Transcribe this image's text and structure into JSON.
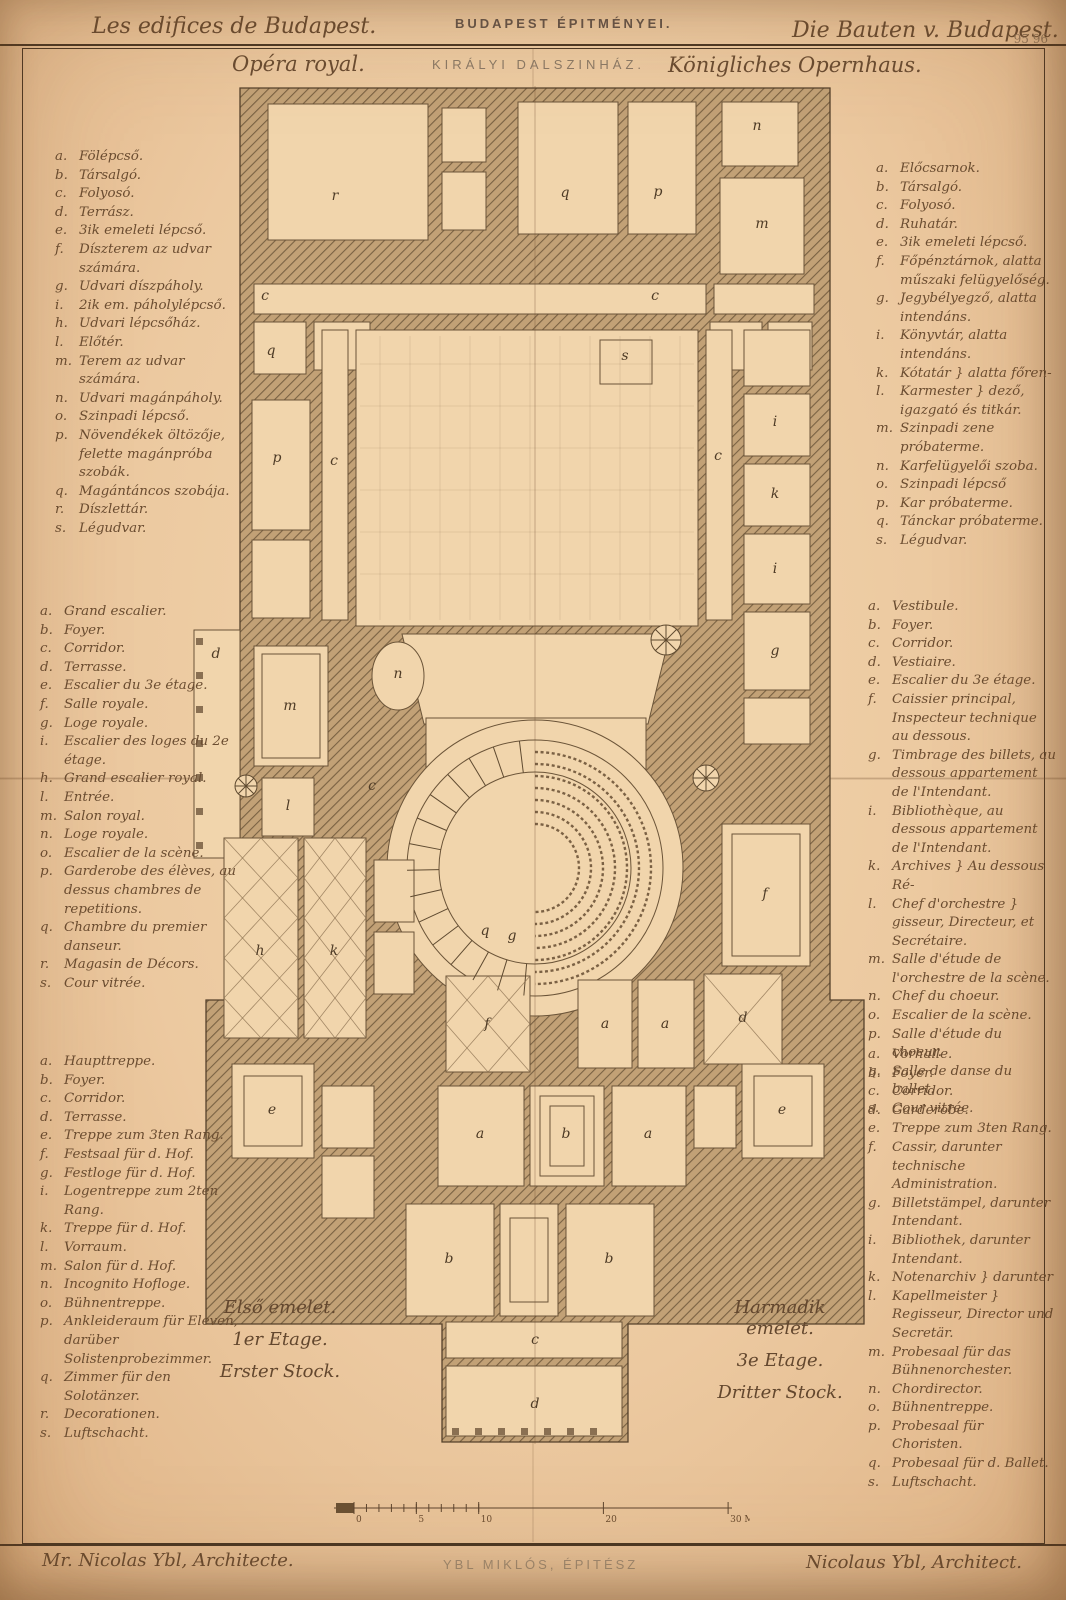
{
  "page": {
    "paper_color": "#ecc9a0",
    "ink_color": "#5d452e"
  },
  "header": {
    "left": "Les edifices de Budapest.",
    "center": "BUDAPEST ÉPITMÉNYEI.",
    "right": "Die Bauten v. Budapest.",
    "plate_number": "95 96"
  },
  "subtitles": {
    "french": "Opéra royal.",
    "hungarian": "KIRÁLYI DALSZINHÁZ.",
    "german": "Königliches Opernhaus."
  },
  "legends": {
    "left_hungarian": {
      "items": [
        {
          "key": "a.",
          "text": "Fölépcső."
        },
        {
          "key": "b.",
          "text": "Társalgó."
        },
        {
          "key": "c.",
          "text": "Folyosó."
        },
        {
          "key": "d.",
          "text": "Terrász."
        },
        {
          "key": "e.",
          "text": "3ik emeleti lépcső."
        },
        {
          "key": "f.",
          "text": "Díszterem az udvar számára."
        },
        {
          "key": "g.",
          "text": "Udvari díszpáholy."
        },
        {
          "key": "i.",
          "text": "2ik em. páholylépcső."
        },
        {
          "key": "h.",
          "text": "Udvari lépcsőház."
        },
        {
          "key": "l.",
          "text": "Előtér."
        },
        {
          "key": "m.",
          "text": "Terem az udvar számára."
        },
        {
          "key": "n.",
          "text": "Udvari magánpáholy."
        },
        {
          "key": "o.",
          "text": "Szinpadi lépcső."
        },
        {
          "key": "p.",
          "text": "Növendékek öltözője, felette magánpróba szobák."
        },
        {
          "key": "q.",
          "text": "Magántáncos szobája."
        },
        {
          "key": "r.",
          "text": "Díszlettár."
        },
        {
          "key": "s.",
          "text": "Légudvar."
        }
      ]
    },
    "left_french": {
      "items": [
        {
          "key": "a.",
          "text": "Grand escalier."
        },
        {
          "key": "b.",
          "text": "Foyer."
        },
        {
          "key": "c.",
          "text": "Corridor."
        },
        {
          "key": "d.",
          "text": "Terrasse."
        },
        {
          "key": "e.",
          "text": "Escalier du 3e étage."
        },
        {
          "key": "f.",
          "text": "Salle royale."
        },
        {
          "key": "g.",
          "text": "Loge royale."
        },
        {
          "key": "i.",
          "text": "Escalier des loges du 2e étage."
        },
        {
          "key": "h.",
          "text": "Grand escalier royal."
        },
        {
          "key": "l.",
          "text": "Entrée."
        },
        {
          "key": "m.",
          "text": "Salon royal."
        },
        {
          "key": "n.",
          "text": "Loge royale."
        },
        {
          "key": "o.",
          "text": "Escalier de la scène."
        },
        {
          "key": "p.",
          "text": "Garderobe des élèves, au dessus chambres de repetitions."
        },
        {
          "key": "q.",
          "text": "Chambre du premier danseur."
        },
        {
          "key": "r.",
          "text": "Magasin de Décors."
        },
        {
          "key": "s.",
          "text": "Cour vitrée."
        }
      ]
    },
    "left_german": {
      "items": [
        {
          "key": "a.",
          "text": "Haupttreppe."
        },
        {
          "key": "b.",
          "text": "Foyer."
        },
        {
          "key": "c.",
          "text": "Corridor."
        },
        {
          "key": "d.",
          "text": "Terrasse."
        },
        {
          "key": "e.",
          "text": "Treppe zum 3ten Rang."
        },
        {
          "key": "f.",
          "text": "Festsaal für d. Hof."
        },
        {
          "key": "g.",
          "text": "Festloge für d. Hof."
        },
        {
          "key": "i.",
          "text": "Logentreppe zum 2ten Rang."
        },
        {
          "key": "k.",
          "text": "Treppe für d. Hof."
        },
        {
          "key": "l.",
          "text": "Vorraum."
        },
        {
          "key": "m.",
          "text": "Salon für d. Hof."
        },
        {
          "key": "n.",
          "text": "Incognito Hofloge."
        },
        {
          "key": "o.",
          "text": "Bühnentreppe."
        },
        {
          "key": "p.",
          "text": "Ankleideraum für Eleven, darüber Solistenprobezimmer."
        },
        {
          "key": "q.",
          "text": "Zimmer für den Solotänzer."
        },
        {
          "key": "r.",
          "text": "Decorationen."
        },
        {
          "key": "s.",
          "text": "Luftschacht."
        }
      ]
    },
    "right_hungarian": {
      "items": [
        {
          "key": "a.",
          "text": "Előcsarnok."
        },
        {
          "key": "b.",
          "text": "Társalgó."
        },
        {
          "key": "c.",
          "text": "Folyosó."
        },
        {
          "key": "d.",
          "text": "Ruhatár."
        },
        {
          "key": "e.",
          "text": "3ik emeleti lépcső."
        },
        {
          "key": "f.",
          "text": "Főpénztárnok, alatta műszaki felügyelőség."
        },
        {
          "key": "g.",
          "text": "Jegybélyegző, alatta intendáns."
        },
        {
          "key": "i.",
          "text": "Könyvtár, alatta intendáns."
        },
        {
          "key": "k.",
          "text": "Kótatár } alatta főren-"
        },
        {
          "key": "l.",
          "text": "Karmester } dező, igazgató és titkár."
        },
        {
          "key": "m.",
          "text": "Szinpadi zene próbaterme."
        },
        {
          "key": "n.",
          "text": "Karfelügyelői szoba."
        },
        {
          "key": "o.",
          "text": "Szinpadi lépcső"
        },
        {
          "key": "p.",
          "text": "Kar próbaterme."
        },
        {
          "key": "q.",
          "text": "Tánckar próbaterme."
        },
        {
          "key": "s.",
          "text": "Légudvar."
        }
      ]
    },
    "right_french": {
      "items": [
        {
          "key": "a.",
          "text": "Vestibule."
        },
        {
          "key": "b.",
          "text": "Foyer."
        },
        {
          "key": "c.",
          "text": "Corridor."
        },
        {
          "key": "d.",
          "text": "Vestiaire."
        },
        {
          "key": "e.",
          "text": "Escalier du 3e étage."
        },
        {
          "key": "f.",
          "text": "Caissier principal, Inspecteur technique au dessous."
        },
        {
          "key": "g.",
          "text": "Timbrage des billets, au dessous appartement de l'Intendant."
        },
        {
          "key": "i.",
          "text": "Bibliothèque, au dessous appartement de l'Intendant."
        },
        {
          "key": "k.",
          "text": "Archives } Au dessous Ré-"
        },
        {
          "key": "l.",
          "text": "Chef d'orchestre } gisseur, Directeur, et Secrétaire."
        },
        {
          "key": "m.",
          "text": "Salle d'étude de l'orchestre de la scène."
        },
        {
          "key": "n.",
          "text": "Chef du choeur."
        },
        {
          "key": "o.",
          "text": "Escalier de la scène."
        },
        {
          "key": "p.",
          "text": "Salle d'étude du choeur."
        },
        {
          "key": "q.",
          "text": "Salle de danse du ballet."
        },
        {
          "key": "s.",
          "text": "Cour vitrée."
        }
      ]
    },
    "right_german": {
      "items": [
        {
          "key": "a.",
          "text": "Vorhalle."
        },
        {
          "key": "b.",
          "text": "Foyer."
        },
        {
          "key": "c.",
          "text": "Corridor."
        },
        {
          "key": "d.",
          "text": "Garderobe."
        },
        {
          "key": "e.",
          "text": "Treppe zum 3ten Rang."
        },
        {
          "key": "f.",
          "text": "Cassir, darunter technische Administration."
        },
        {
          "key": "g.",
          "text": "Billetstämpel, darunter Intendant."
        },
        {
          "key": "i.",
          "text": "Bibliothek, darunter Intendant."
        },
        {
          "key": "k.",
          "text": "Notenarchiv } darunter"
        },
        {
          "key": "l.",
          "text": "Kapellmeister } Regisseur, Director und Secretär."
        },
        {
          "key": "m.",
          "text": "Probesaal für das Bühnenorchester."
        },
        {
          "key": "n.",
          "text": "Chordirector."
        },
        {
          "key": "o.",
          "text": "Bühnentreppe."
        },
        {
          "key": "p.",
          "text": "Probesaal für Choristen."
        },
        {
          "key": "q.",
          "text": "Probesaal für d. Ballet."
        },
        {
          "key": "s.",
          "text": "Luftschacht."
        }
      ]
    }
  },
  "floor_labels": {
    "left": [
      "Első emelet.",
      "1er Etage.",
      "Erster Stock."
    ],
    "right": [
      "Harmadik emelet.",
      "3e Etage.",
      "Dritter Stock."
    ]
  },
  "scale_bar": {
    "unit_labels": [
      {
        "v": 0,
        "t": "0"
      },
      {
        "v": 5,
        "t": "5"
      },
      {
        "v": 10,
        "t": "10"
      },
      {
        "v": 20,
        "t": "20"
      },
      {
        "v": 30,
        "t": "30 M."
      }
    ]
  },
  "footer": {
    "left": "Mr. Nicolas Ybl, Architecte.",
    "center": "YBL MIKLÓS, ÉPITÉSZ",
    "right": "Nicolaus Ybl, Architect."
  },
  "plan_letters": [
    {
      "t": "r",
      "x": 185,
      "y": 122
    },
    {
      "t": "q",
      "x": 415,
      "y": 119
    },
    {
      "t": "p",
      "x": 508,
      "y": 118
    },
    {
      "t": "n",
      "x": 607,
      "y": 52
    },
    {
      "t": "m",
      "x": 612,
      "y": 150
    },
    {
      "t": "c",
      "x": 115,
      "y": 222
    },
    {
      "t": "c",
      "x": 505,
      "y": 222
    },
    {
      "t": "q",
      "x": 121,
      "y": 277
    },
    {
      "t": "s",
      "x": 475,
      "y": 282
    },
    {
      "t": "p",
      "x": 127,
      "y": 384
    },
    {
      "t": "c",
      "x": 184,
      "y": 387
    },
    {
      "t": "c",
      "x": 568,
      "y": 382
    },
    {
      "t": "i",
      "x": 625,
      "y": 348
    },
    {
      "t": "k",
      "x": 625,
      "y": 420
    },
    {
      "t": "i",
      "x": 625,
      "y": 495
    },
    {
      "t": "g",
      "x": 625,
      "y": 577
    },
    {
      "t": "d",
      "x": 66,
      "y": 580
    },
    {
      "t": "m",
      "x": 140,
      "y": 632
    },
    {
      "t": "n",
      "x": 248,
      "y": 600
    },
    {
      "t": "l",
      "x": 138,
      "y": 732
    },
    {
      "t": "c",
      "x": 222,
      "y": 712
    },
    {
      "t": "h",
      "x": 110,
      "y": 877
    },
    {
      "t": "k",
      "x": 184,
      "y": 877
    },
    {
      "t": "q",
      "x": 335,
      "y": 857
    },
    {
      "t": "g",
      "x": 362,
      "y": 862
    },
    {
      "t": "f",
      "x": 615,
      "y": 820
    },
    {
      "t": "f",
      "x": 337,
      "y": 950
    },
    {
      "t": "a",
      "x": 455,
      "y": 950
    },
    {
      "t": "a",
      "x": 515,
      "y": 950
    },
    {
      "t": "d",
      "x": 593,
      "y": 944
    },
    {
      "t": "e",
      "x": 122,
      "y": 1036
    },
    {
      "t": "e",
      "x": 632,
      "y": 1036
    },
    {
      "t": "a",
      "x": 330,
      "y": 1060
    },
    {
      "t": "b",
      "x": 416,
      "y": 1060
    },
    {
      "t": "a",
      "x": 498,
      "y": 1060
    },
    {
      "t": "b",
      "x": 299,
      "y": 1185
    },
    {
      "t": "b",
      "x": 459,
      "y": 1185
    },
    {
      "t": "c",
      "x": 385,
      "y": 1266
    },
    {
      "t": "d",
      "x": 385,
      "y": 1330
    }
  ]
}
